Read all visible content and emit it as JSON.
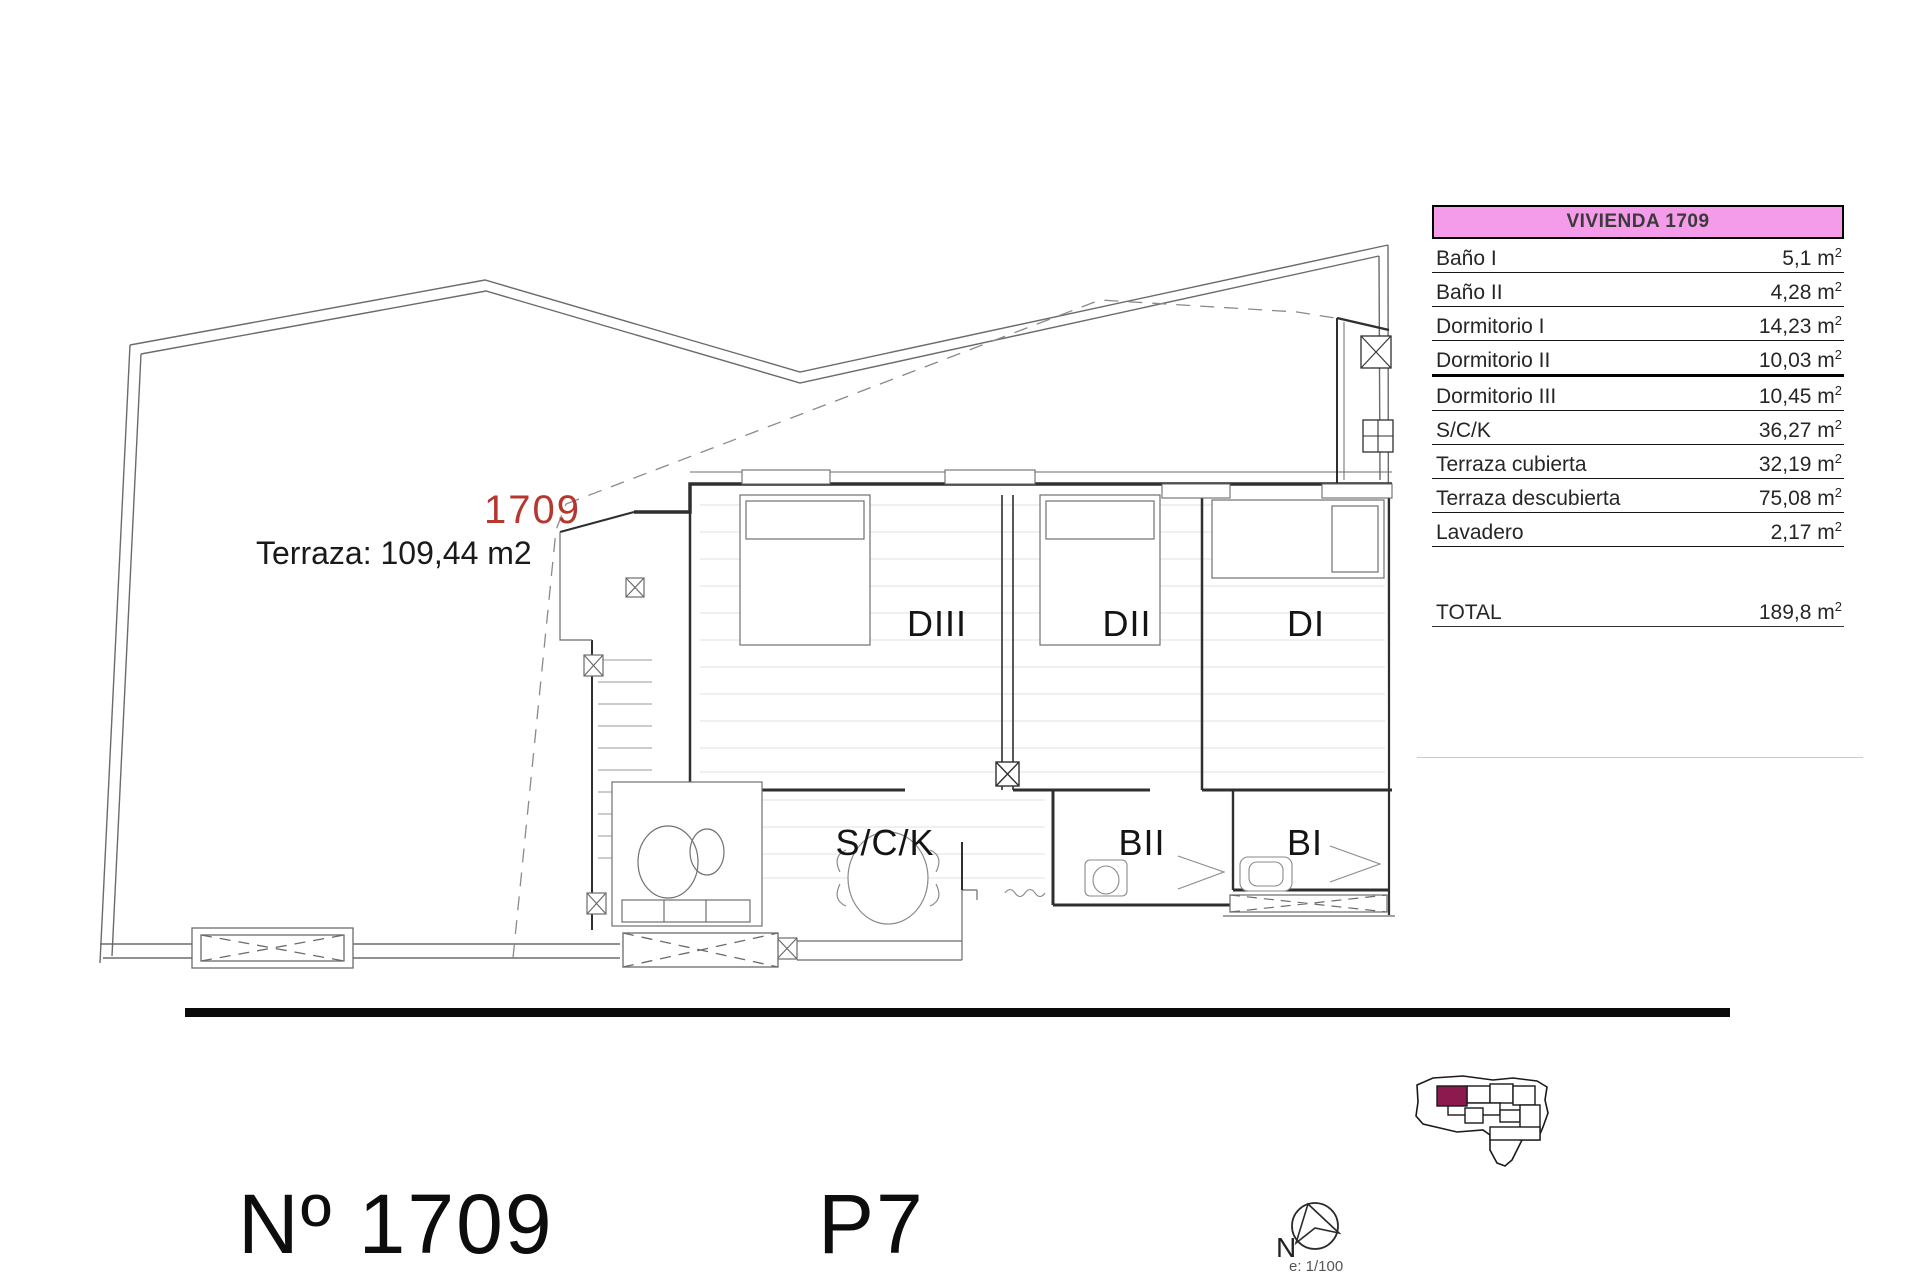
{
  "plan": {
    "unit_number_label": "1709",
    "terrace_label": "Terraza: 109,44 m2",
    "room_labels": {
      "dormitorio_iii": "DIII",
      "dormitorio_ii": "DII",
      "dormitorio_i": "DI",
      "salon_cocina": "S/C/K",
      "bano_ii": "BII",
      "bano_i": "BI"
    }
  },
  "table": {
    "header": "VIVIENDA 1709",
    "rows": [
      {
        "label": "Baño I",
        "value": "5,1",
        "unit": "m2",
        "thick_rule": false
      },
      {
        "label": "Baño II",
        "value": "4,28",
        "unit": "m2",
        "thick_rule": false
      },
      {
        "label": "Dormitorio I",
        "value": "14,23",
        "unit": "m2",
        "thick_rule": false
      },
      {
        "label": "Dormitorio II",
        "value": "10,03",
        "unit": "m2",
        "thick_rule": true
      },
      {
        "label": "Dormitorio III",
        "value": "10,45",
        "unit": "m2",
        "thick_rule": false
      },
      {
        "label": "S/C/K",
        "value": "36,27",
        "unit": "m2",
        "thick_rule": false
      },
      {
        "label": "Terraza cubierta",
        "value": "32,19",
        "unit": "m2",
        "thick_rule": false
      },
      {
        "label": "Terraza descubierta",
        "value": "75,08",
        "unit": "m2",
        "thick_rule": false
      },
      {
        "label": "Lavadero",
        "value": "2,17",
        "unit": "m2",
        "thick_rule": false
      }
    ],
    "total": {
      "label": "TOTAL",
      "value": "189,8",
      "unit": "m2"
    }
  },
  "footer": {
    "unit_title": "Nº 1709",
    "floor_label": "P7",
    "north_label": "N",
    "scale_label": "e: 1/100"
  },
  "colors": {
    "accent_pink": "#f49bea",
    "unit_red": "#b5372e",
    "keyplan_maroon": "#8c1a4e",
    "line_gray": "#6b6b6b",
    "wall_dark": "#2f2f2f"
  }
}
